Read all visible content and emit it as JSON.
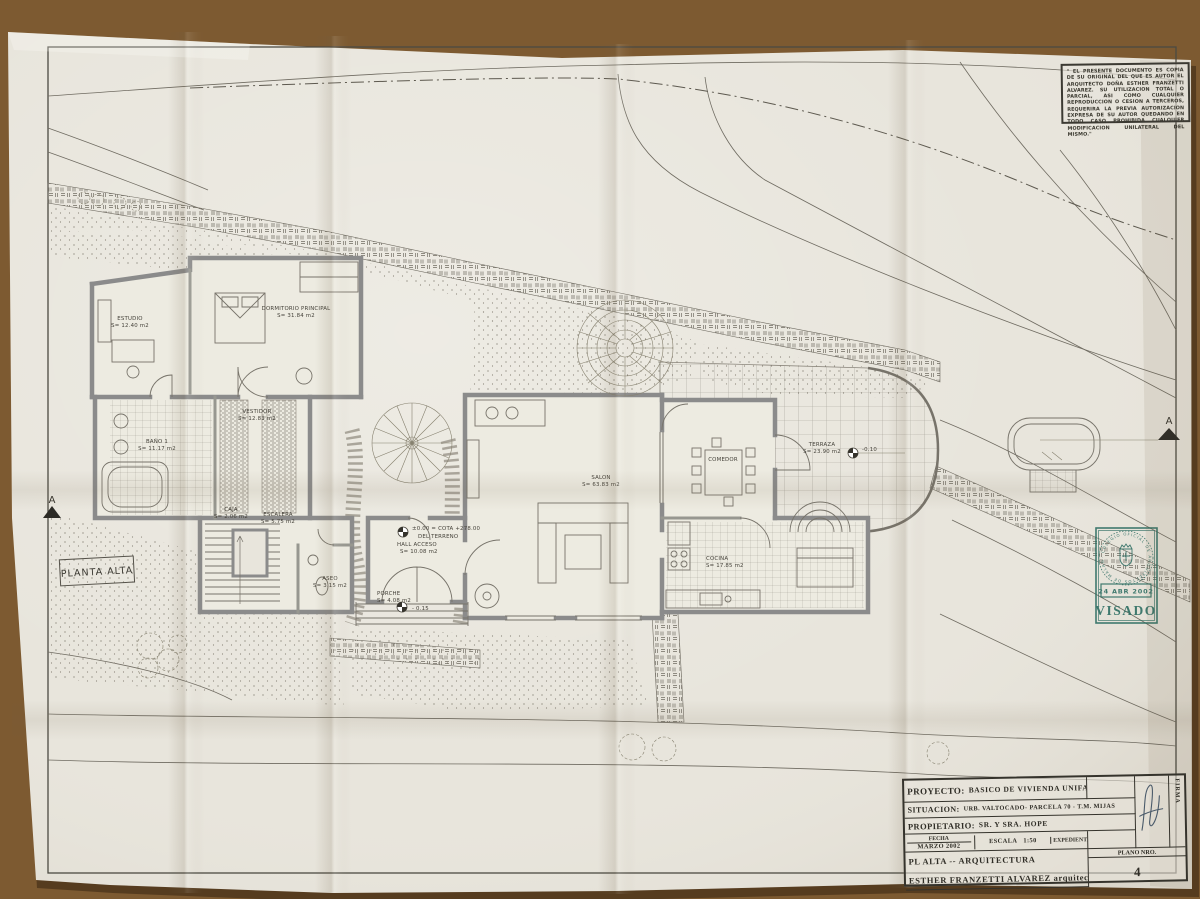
{
  "sheet": {
    "plan_label": "PLANTA ALTA",
    "section_marker": "A",
    "disclaimer": "\" EL PRESENTE DOCUMENTO ES COPIA DE SU ORIGINAL DEL QUE ES AUTOR EL ARQUITECTO DOÑA ESTHER FRANZETTI ALVAREZ. SU UTILIZACION TOTAL O PARCIAL, ASI COMO CUALQUIER REPRODUCCION O CESION A TERCEROS, REQUERIRA LA PREVIA AUTORIZACION EXPRESA DE SU AUTOR QUEDANDO EN TODO CASO PROHIBIDA CUALQUIER MODIFICACION UNILATERAL DEL MISMO.\"",
    "rooms": [
      {
        "name": "ESTUDIO",
        "area": "S= 12.40 m2"
      },
      {
        "name": "DORMITORIO PRINCIPAL",
        "area": "S= 31.84 m2"
      },
      {
        "name": "BAÑO 1",
        "area": "S= 11.17 m2"
      },
      {
        "name": "VESTIDOR",
        "area": "S= 12.83 m2"
      },
      {
        "name": "CAJA",
        "area": "S= 2.06 m2"
      },
      {
        "name": "ESCALERA",
        "area": "S= 5.75 m2"
      },
      {
        "name": "ASEO",
        "area": "S= 3.15 m2"
      },
      {
        "name": "HALL ACCESO",
        "area": "S= 10.08 m2"
      },
      {
        "name": "PORCHE",
        "area": "S= 4.08 m2"
      },
      {
        "name": "SALON",
        "area": "S= 63.83 m2"
      },
      {
        "name": "COMEDOR",
        "area": ""
      },
      {
        "name": "COCINA",
        "area": "S= 17.85 m2"
      },
      {
        "name": "TERRAZA",
        "area": "S= 23.90 m2"
      }
    ],
    "levels": {
      "cota": "±0.00 = COTA +278.00",
      "terrain": "DEL TERRENO",
      "porch_level": "- 0.15",
      "terrace_level": "-0.10"
    },
    "stamp": {
      "ring_text": "· COLEGIO OFICIAL DE ARQUITECTOS DE MALAGA ·",
      "date": "24 ABR 2002",
      "label": "VISADO",
      "color": "#2e6e63"
    },
    "title_block": {
      "proyecto_label": "PROYECTO:",
      "proyecto": "BASICO  DE VIVIENDA UNIFAMILIAR",
      "situacion_label": "SITUACION:",
      "situacion": "URB. VALTOCADO- PARCELA 70 - T.M.  MIJAS",
      "propietario_label": "PROPIETARIO:",
      "propietario": "SR. Y SRA.  HOPE",
      "fecha_label": "FECHA",
      "fecha": "MARZO 2002",
      "escala_label": "ESCALA",
      "escala": "1:50",
      "expediente_label": "EXPEDIENTE",
      "firma_label": "FIRMA",
      "plano_label": "PLANO NRO.",
      "plano_numero": "4",
      "plano_linea": "PL ALTA --  ARQUITECTURA",
      "autor": "ESTHER FRANZETTI ALVAREZ  arquitecto"
    }
  }
}
